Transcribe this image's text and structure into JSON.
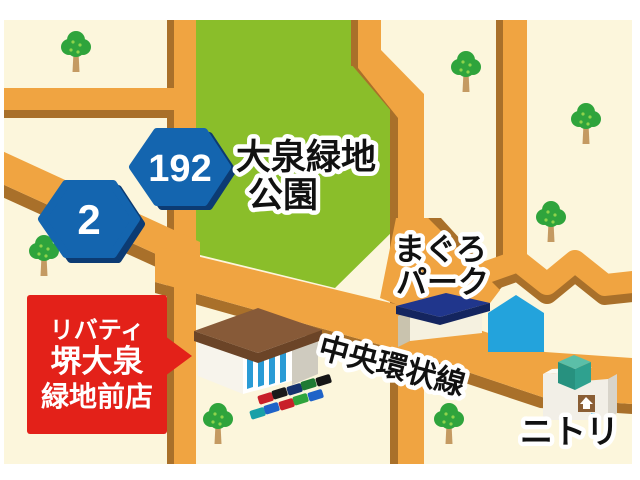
{
  "map_labels": {
    "park_name_line1": "大泉緑地",
    "park_name_line2": "公園",
    "maguro_park_line1": "まぐろ",
    "maguro_park_line2": "パーク",
    "chuo_kanjo_road": "中央環状線",
    "nitori": "ニトリ"
  },
  "route_signs": [
    {
      "number": "192"
    },
    {
      "number": "2"
    }
  ],
  "store_callout": {
    "line1": "リバティ",
    "line2": "堺大泉",
    "line3": "緑地前店"
  },
  "colors": {
    "frame_white": "#FFFFFF",
    "background_beige": "#FCF6DC",
    "park_green": "#8ABE2A",
    "road_orange": "#F0A441",
    "road_shadow_brown": "#A9702A",
    "route_sign_blue": "#1465AF",
    "route_sign_shadow": "#0C3B73",
    "callout_red": "#E32119",
    "callout_text_white": "#FFFFFF",
    "label_text_black": "#111111",
    "label_outline_white": "#FFFFFF",
    "blue_building_cyan": "#23A3DC",
    "maguro_roof_navy": "#20368C",
    "store_roof_brown": "#875A38",
    "nitori_cube_teal": "#2FA18F",
    "tree_green": "#2FA43C",
    "tree_trunk": "#C49A62"
  }
}
